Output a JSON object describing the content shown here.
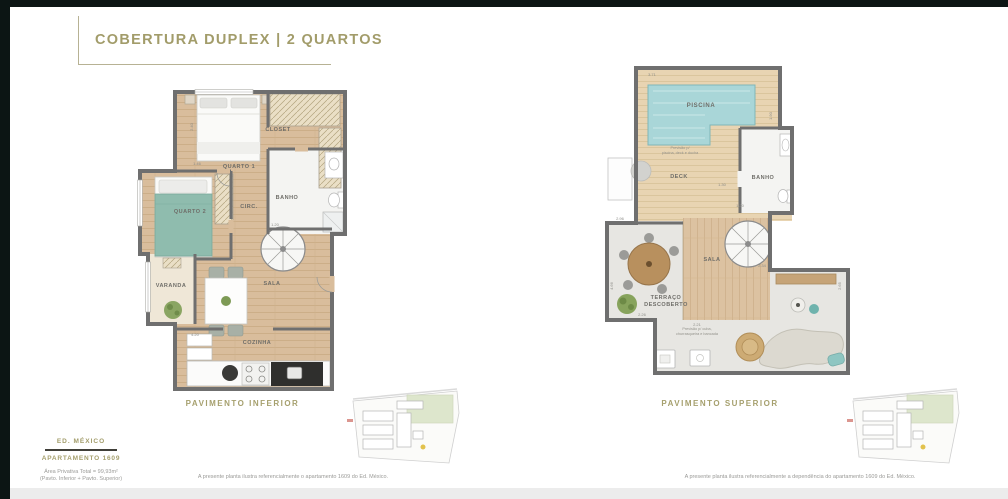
{
  "header": {
    "title": "COBERTURA DUPLEX | 2 QUARTOS"
  },
  "plans": {
    "inferior": {
      "caption": "PAVIMENTO INFERIOR",
      "rooms": {
        "quarto1": "QUARTO 1",
        "closet": "CLOSET",
        "banho": "BANHO",
        "circ": "CIRC.",
        "quarto2": "QUARTO 2",
        "varanda": "VARANDA",
        "sala": "SALA",
        "cozinha": "COZINHA"
      },
      "dims": [
        {
          "v": "2.40"
        },
        {
          "v": "1.46"
        },
        {
          "v": "1.20"
        },
        {
          "v": "4.20"
        }
      ],
      "disclaimer": "A presente planta ilustra referencialmente o apartamento 1609 do Ed. México."
    },
    "superior": {
      "caption": "PAVIMENTO SUPERIOR",
      "rooms": {
        "piscina": "PISCINA",
        "deck": "DECK",
        "banho": "BANHO",
        "sala": "SALA",
        "terraco_l1": "TERRAÇO",
        "terraco_l2": "DESCOBERTO"
      },
      "notes": {
        "pool_l1": "Previsão p/",
        "pool_l2": "piscina, deck e ducha",
        "bbq_l1": "Previsão p/ cuba,",
        "bbq_l2": "churrasqueira e bancada"
      },
      "dims": [
        {
          "v": "3.71"
        },
        {
          "v": "1.90"
        },
        {
          "v": "1.30"
        },
        {
          "v": "1.20"
        },
        {
          "v": "2.34"
        },
        {
          "v": "2.65"
        },
        {
          "v": "2.21"
        },
        {
          "v": "2.96"
        },
        {
          "v": "4.66"
        },
        {
          "v": "2.26"
        }
      ],
      "disclaimer": "A presente planta ilustra referencialmente a dependência do apartamento 1609 do Ed. México."
    }
  },
  "footer": {
    "building": "ED. MÉXICO",
    "apartment": "APARTAMENTO 1609",
    "area_line1": "Área Privativa Total = 99,93m²",
    "area_line2": "(Pavto. Inferior + Pavto. Superior)"
  },
  "colors": {
    "accent": "#a6a06e",
    "wall": "#6f6f6f",
    "pool": "#a9d6d8",
    "wood": "#d9bd9c",
    "deck": "#e8d4b2",
    "dark_strip": "#0c1514"
  }
}
